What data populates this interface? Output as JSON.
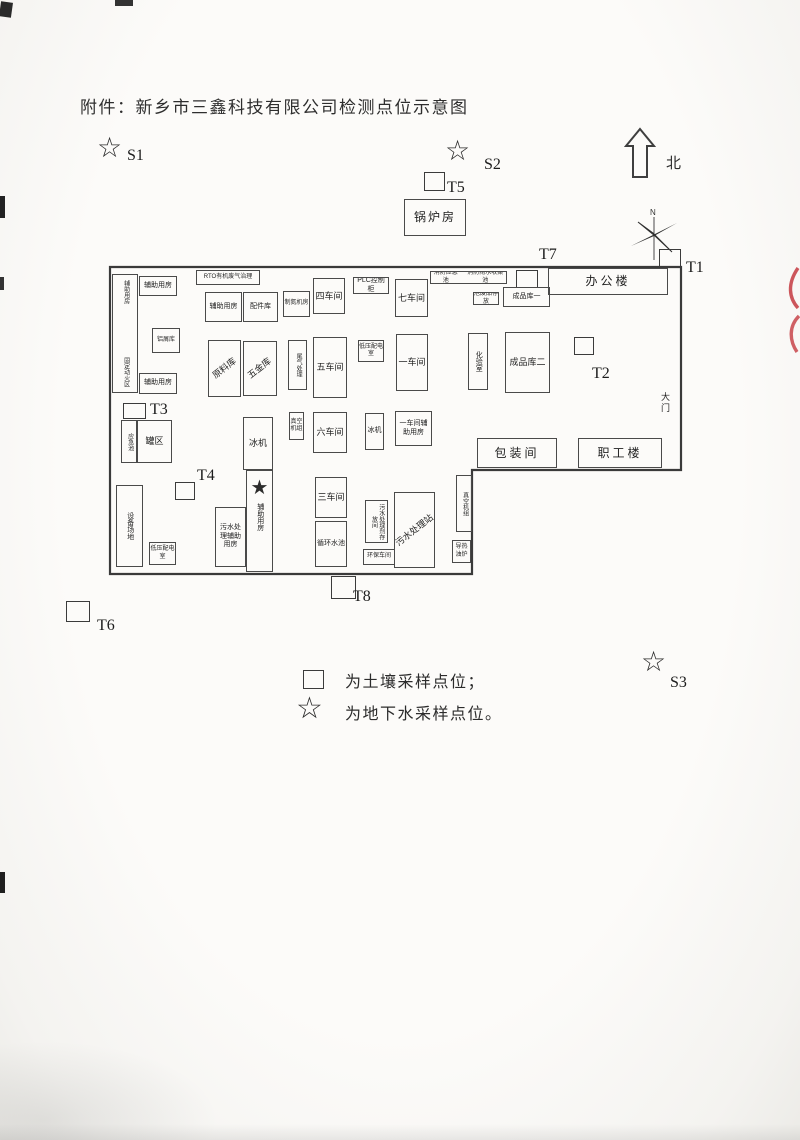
{
  "title": "附件：新乡市三鑫科技有限公司检测点位示意图",
  "north": {
    "label": "北",
    "compass_n": "N"
  },
  "legend": {
    "soil_note": "为土壤采样点位；",
    "groundwater_note": "为地下水采样点位。"
  },
  "points": {
    "t1": "T1",
    "t2": "T2",
    "t3": "T3",
    "t4": "T4",
    "t5": "T5",
    "t6": "T6",
    "t7": "T7",
    "t8": "T8",
    "s1": "S1",
    "s2": "S2",
    "s3": "S3"
  },
  "symbols": {
    "groundwater_star": "☆",
    "location_star": "★"
  },
  "buildings": {
    "boiler": "锅炉房",
    "office": "办公楼",
    "gate": "大门",
    "aux_left": "辅助用房",
    "fixed_fire_zone": "固定动火区",
    "aux_top": "辅助用房",
    "scrap_store": "铝屑库",
    "aux_top2": "辅助用房",
    "rto": "RTO有机废气治理",
    "aux_mid": "辅助用房",
    "parts_store": "配件库",
    "nitrogen_room": "制氮机房",
    "workshop4": "四车间",
    "plc_cabinet": "PLC控制柜",
    "workshop7": "七车间",
    "fire_emergency_pool": "消防应急池",
    "fire_rain_pool": "消防雨水收集池",
    "hazwaste_store": "危废品存放",
    "finished_goods_1": "成品库一",
    "raw_material_store": "原料库",
    "hardware_store": "五金库",
    "tail_gas_treatment": "尾气处理",
    "workshop5": "五车间",
    "lv_power_room_1": "低压配电室",
    "workshop1": "一车间",
    "lab": "化验室",
    "finished_goods_2": "成品库二",
    "emergency_pool": "应急池",
    "tank_area": "罐区",
    "chiller_1": "冰机",
    "vacuum_unit_1": "真空机组",
    "workshop6": "六车间",
    "chiller_2": "冰机",
    "workshop1_aux": "一车间辅助用房",
    "packing_room": "包装间",
    "staff_building": "职工楼",
    "equipment_yard": "设备场地",
    "lv_power_room_2": "低压配电室",
    "sewage_aux_room": "污水处理辅助用房",
    "aux_star_room": "辅助用房",
    "workshop3": "三车间",
    "circulating_pool": "循环水池",
    "sewage_agent_store": "污水处理剂存放间",
    "sewage_station": "污水处理站",
    "env_workshop": "环保车间",
    "vacuum_unit_2": "真空机组",
    "oil_furnace": "导热油炉"
  }
}
